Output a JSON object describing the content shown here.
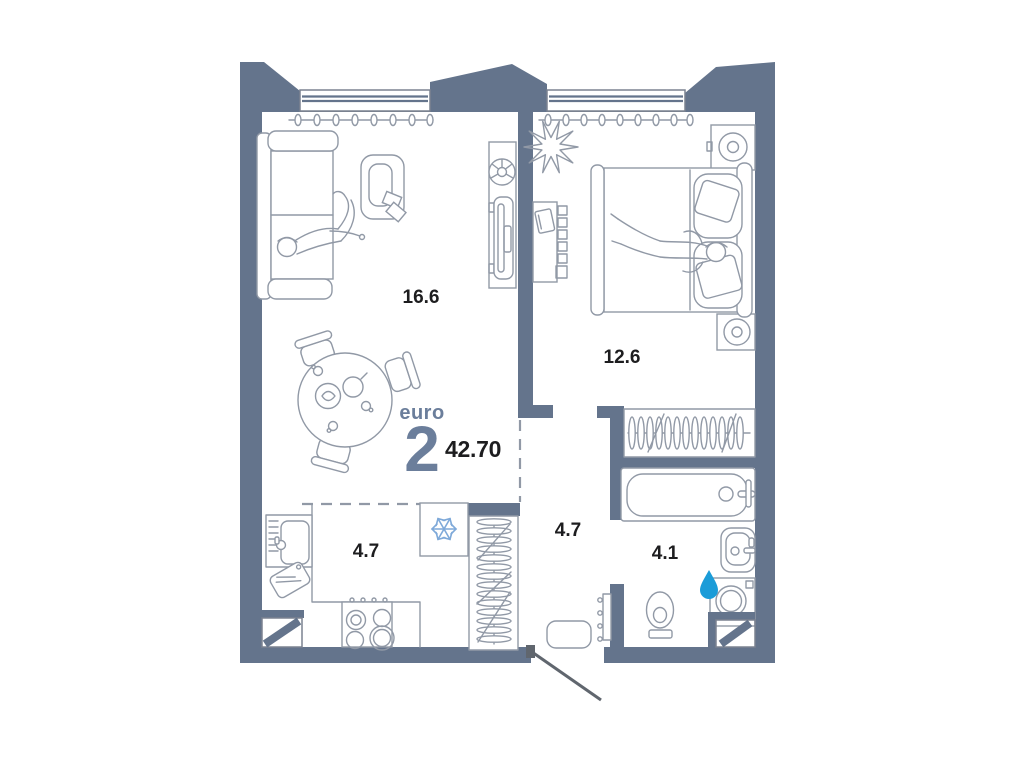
{
  "plan": {
    "type_label": "euro",
    "rooms_count": "2",
    "total_area": "42.70",
    "rooms": [
      {
        "id": "living-room",
        "area": "16.6"
      },
      {
        "id": "bedroom",
        "area": "12.6"
      },
      {
        "id": "kitchen",
        "area": "4.7"
      },
      {
        "id": "hallway",
        "area": "4.7"
      },
      {
        "id": "bathroom",
        "area": "4.1"
      }
    ],
    "colors": {
      "wall": "#64748c",
      "line": "#9199a6",
      "line_dark": "#7b8290",
      "text": "#1d1d1f",
      "accent": "#6b7e9b",
      "snowflake": "#7ea9d9",
      "drop": "#1b9cd8",
      "door": "#60666e"
    }
  }
}
